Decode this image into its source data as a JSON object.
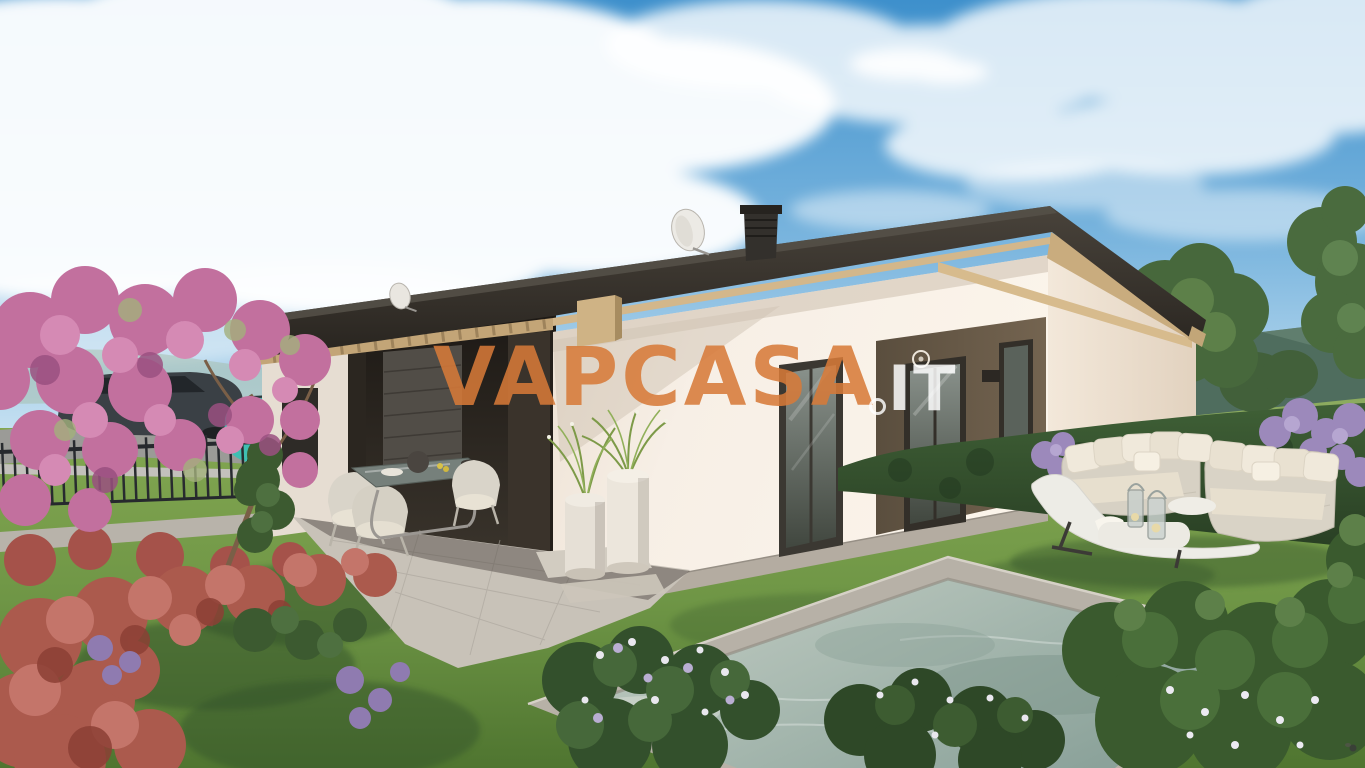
{
  "meta": {
    "type": "natural-image",
    "subject": "Photorealistic 3D architectural rendering of a modern single-storey villa with wooden roof beams, covered terrace, garden lawn, outdoor lounge furniture and a swimming pool"
  },
  "watermark": {
    "brand": "VAPCASA",
    "tld": "IT",
    "brand_color": "#d77a38",
    "tld_color": "#ffffff"
  },
  "palette": {
    "sky_top": "#3e90cc",
    "sky_horizon": "#c8e2f2",
    "roof_dark": "#2f2a25",
    "wood_beam": "#c9ac7e",
    "wall_white": "#f7efe6",
    "wall_panel_brown": "#6a5c49",
    "terrace_paving": "#c8c2b8",
    "lawn_green": "#6f9646",
    "pool_water": "#9fb3aa",
    "car_teal": "#3fbfb2",
    "blossom_pink": "#c2709e",
    "maple_red": "#ab5a4d",
    "lilac_purple": "#9c89bb",
    "cushion_cream": "#efe8d9"
  },
  "scene": {
    "objects": [
      "sky with clouds",
      "distant mountains",
      "green hedge with lilac",
      "modern villa",
      "dark pitched roof",
      "chimney",
      "satellite dishes",
      "covered terrace with pillars",
      "garage door",
      "glazed doors",
      "brown facade panel",
      "teal SUV behind metal fence",
      "dark parked car",
      "pink blossom tree",
      "red japanese maple",
      "outdoor dining set",
      "planters with ornamental grass",
      "wicker lounge sofas with cushions",
      "white sun lounger",
      "lanterns on low table",
      "swimming pool with stone coping",
      "flowering shrubs"
    ]
  }
}
